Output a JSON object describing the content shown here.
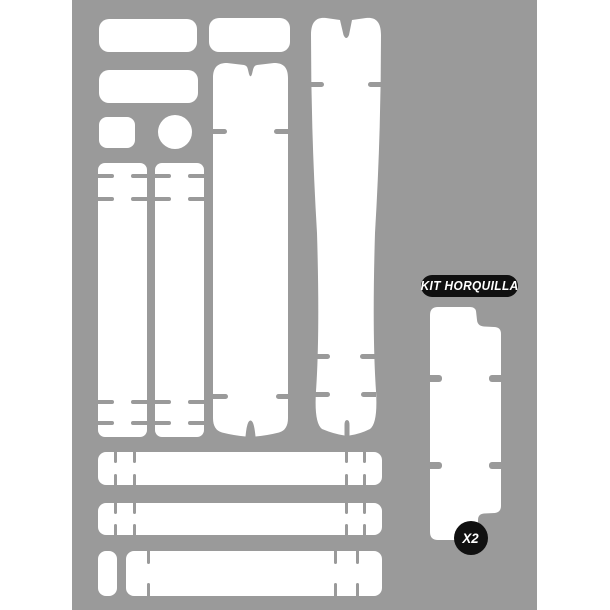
{
  "product": {
    "kit_label": "KIT HORQUILLA",
    "quantity_badge": "X2"
  },
  "colors": {
    "page_background": "#ffffff",
    "board_background": "#9a9a9a",
    "piece_fill": "#ffffff",
    "label_background": "#101010",
    "label_text": "#ffffff"
  }
}
